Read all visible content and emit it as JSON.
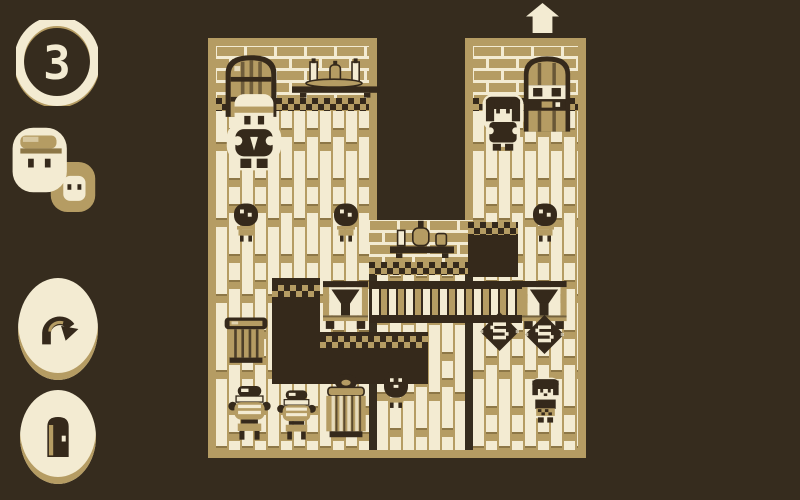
{
  "palette": {
    "background": "#362c1e",
    "ink_dark": "#35291b",
    "tan": "#b59c63",
    "tan_shadow": "#8d7747",
    "cream": "#f3ebd2"
  },
  "hud": {
    "moves_count": "3",
    "portraits": [
      {
        "icon": "man-with-cap-portrait-icon",
        "active": true
      },
      {
        "icon": "woman-portrait-icon",
        "active": false
      }
    ],
    "buttons": [
      {
        "id": "undo",
        "icon": "undo-arrow-icon"
      },
      {
        "id": "door",
        "icon": "door-icon"
      }
    ]
  },
  "board": {
    "shape": "u-shaped-tavern-room",
    "exit_marker_icon": "up-arrow-marker",
    "characters": [
      {
        "name": "man-with-cap",
        "location": "top-left-room"
      },
      {
        "name": "woman",
        "location": "top-right-room"
      },
      {
        "name": "girl",
        "location": "bottom-right"
      }
    ],
    "wall_fixtures": [
      {
        "name": "barrel",
        "location": "top-left-wall"
      },
      {
        "name": "shelf-with-bottles",
        "location": "top-left-wall"
      },
      {
        "name": "cupboard-door",
        "location": "top-right-wall"
      },
      {
        "name": "shelf-with-bottles",
        "location": "middle-wall"
      }
    ],
    "props": [
      {
        "name": "jar-on-stand",
        "location": "left-middle"
      },
      {
        "name": "jar-on-stand",
        "location": "center-middle"
      },
      {
        "name": "jar-on-stand",
        "location": "right-middle"
      },
      {
        "name": "dark-table",
        "location": "center-right"
      },
      {
        "name": "l-shaped-counter",
        "location": "center-left"
      },
      {
        "name": "hopper-press",
        "location": "left-of-bar"
      },
      {
        "name": "bar-railing",
        "location": "center"
      },
      {
        "name": "hopper-press",
        "location": "right-of-bar"
      },
      {
        "name": "s-token",
        "location": "right-column-1"
      },
      {
        "name": "s-token",
        "location": "right-column-2"
      },
      {
        "name": "open-basket",
        "location": "bottom-left"
      },
      {
        "name": "lidded-pot",
        "location": "bottom-row-1"
      },
      {
        "name": "lidded-pot",
        "location": "bottom-row-2"
      },
      {
        "name": "lidded-basket",
        "location": "bottom-row-3"
      },
      {
        "name": "dark-jar",
        "location": "on-counter-corner"
      }
    ]
  }
}
